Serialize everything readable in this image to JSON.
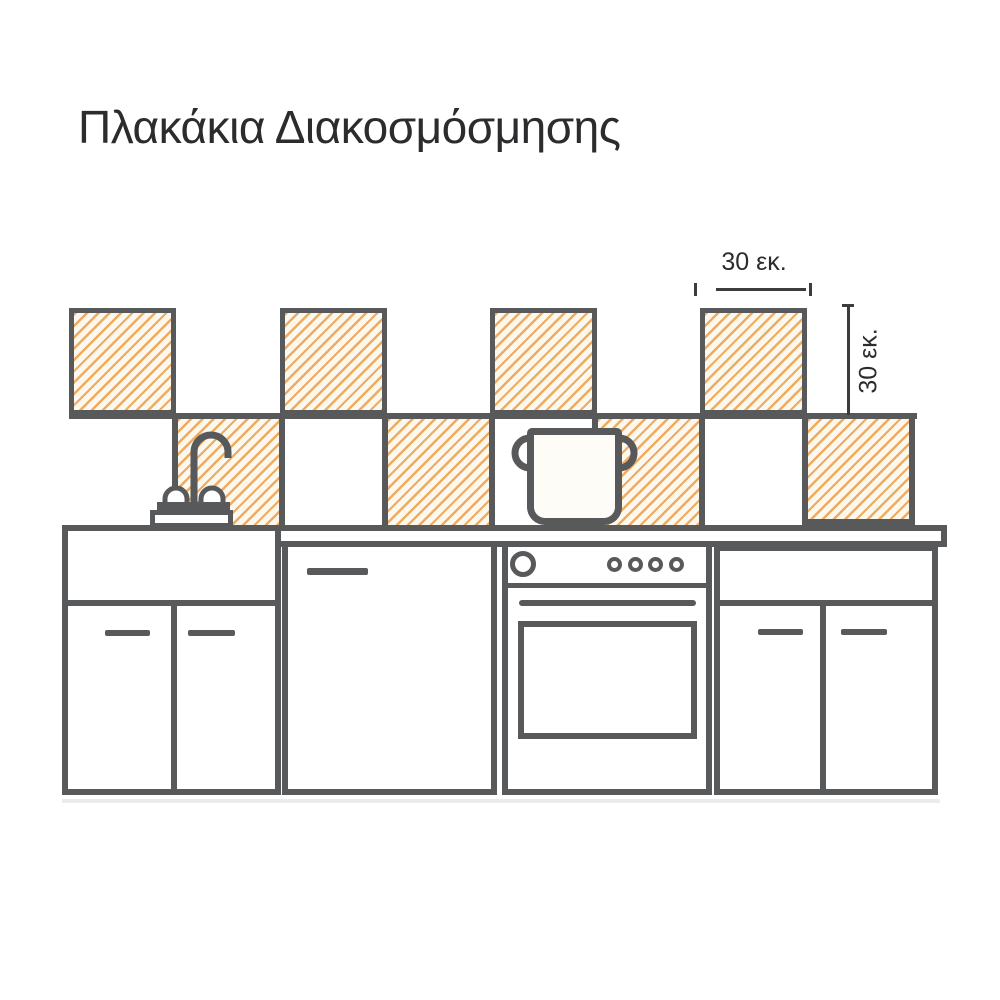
{
  "title": "Πλακάκια Διακοσμόσμησης",
  "annotations": {
    "tile_width_label": "30 εκ.",
    "tile_height_label": "30 εκ."
  },
  "colors": {
    "outline": "#58595b",
    "dimension_line": "#3c3c3e",
    "text": "#2c2c2e",
    "hatch_stripe": "#efab60",
    "tile_fill": "#fdf8ed",
    "background": "#ffffff",
    "shadow": "#ececec"
  }
}
